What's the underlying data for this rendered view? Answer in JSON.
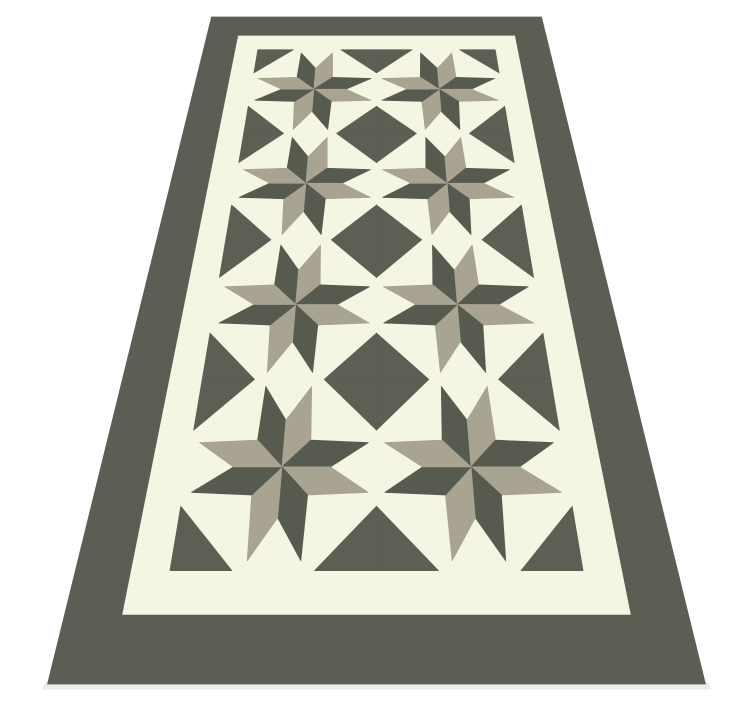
{
  "scene": {
    "type": "product-illustration",
    "subject": "quilt-pattern runner rug with eight-pointed pinwheel star blocks, shown lying on the floor in perspective",
    "background_color": "#ffffff"
  },
  "rug": {
    "colors": {
      "border": "#5c5e53",
      "cream": "#f4f5e3",
      "star_dark": "#575a4e",
      "star_taupe": "#a9a391",
      "corner_dark": "#5d5f54",
      "shadow": "#dcdcda"
    },
    "perspective": {
      "top_y": 17,
      "bottom_y": 684,
      "center_x": 376.5,
      "top_width": 330,
      "bottom_width": 658
    },
    "layout": {
      "border_width_frac": 0.093,
      "band_width_frac": 0.064,
      "columns": 2,
      "rows": 4,
      "corner_triangle_leg_frac": 0.3
    },
    "star": {
      "points": 8,
      "pairs_per_block": 4,
      "tip_radius_frac_of_half_block": 0.95,
      "tip_offset_deg": 16,
      "notch_radius_frac_of_tip": 0.54,
      "side_vertex_radius_frac_of_tip": 0.43,
      "side_vertex_angle_deg": 45
    }
  }
}
